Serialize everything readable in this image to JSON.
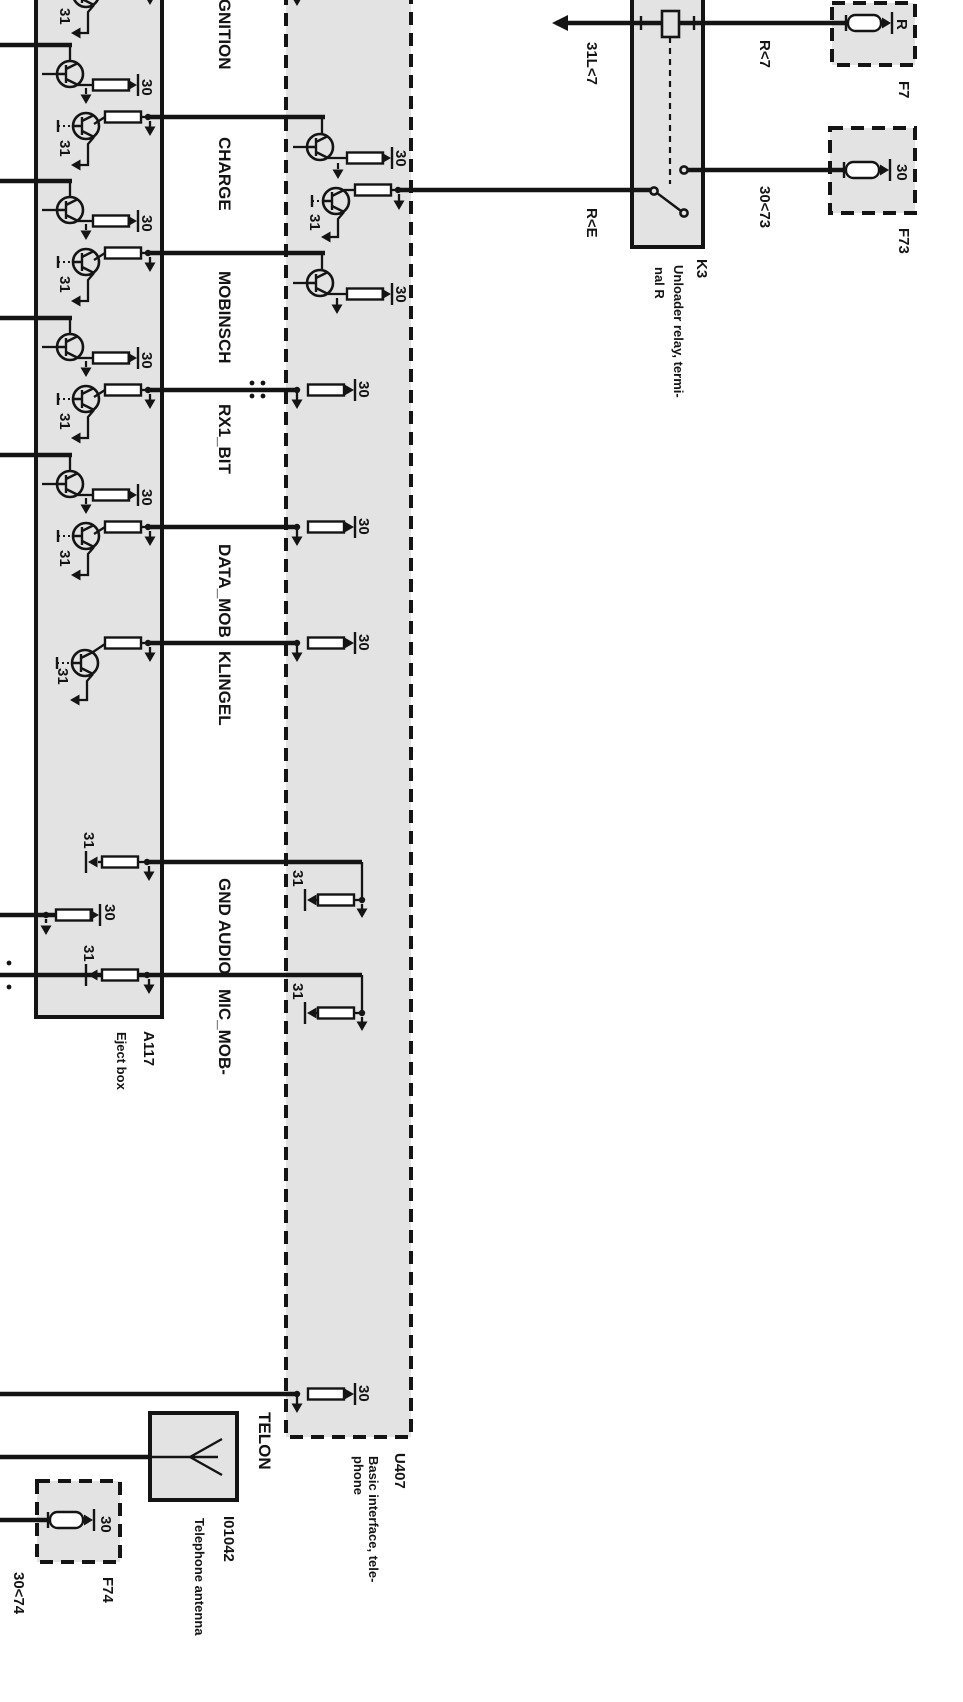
{
  "diagram": {
    "signals": {
      "ignition": "IGNITION",
      "charge": "CHARGE",
      "mobinsch": "MOBINSCH",
      "rx1_bit": "RX1_BIT",
      "data_mob": "DATA_MOB",
      "klingel": "KLINGEL",
      "gnd_audio": "GND AUDIO",
      "mic_mob": "MIC_MOB-",
      "telon": "TELON"
    },
    "terminals": {
      "t30": "30",
      "t31": "31"
    },
    "wire_labels": {
      "w31l7": "31L<7",
      "wr7": "R<7",
      "wre": "R<E",
      "w3073": "30<73",
      "w3074": "30<74"
    },
    "components": {
      "k3": {
        "id": "K3",
        "desc1": "Unloader relay, termi-",
        "desc2": "nal R"
      },
      "a117": {
        "id": "A117",
        "desc": "Eject box"
      },
      "u407": {
        "id": "U407",
        "desc1": "Basic interface, tele-",
        "desc2": "phone"
      },
      "i01042": {
        "id": "I01042",
        "desc": "Telephone antenna"
      },
      "f7": {
        "id": "F7",
        "terminal": "R"
      },
      "f73": {
        "id": "F73",
        "terminal": "30"
      },
      "f74": {
        "id": "F74",
        "terminal": "30"
      }
    },
    "colors": {
      "box_fill": "#e3e3e3",
      "line": "#141414",
      "background": "#ffffff"
    }
  }
}
